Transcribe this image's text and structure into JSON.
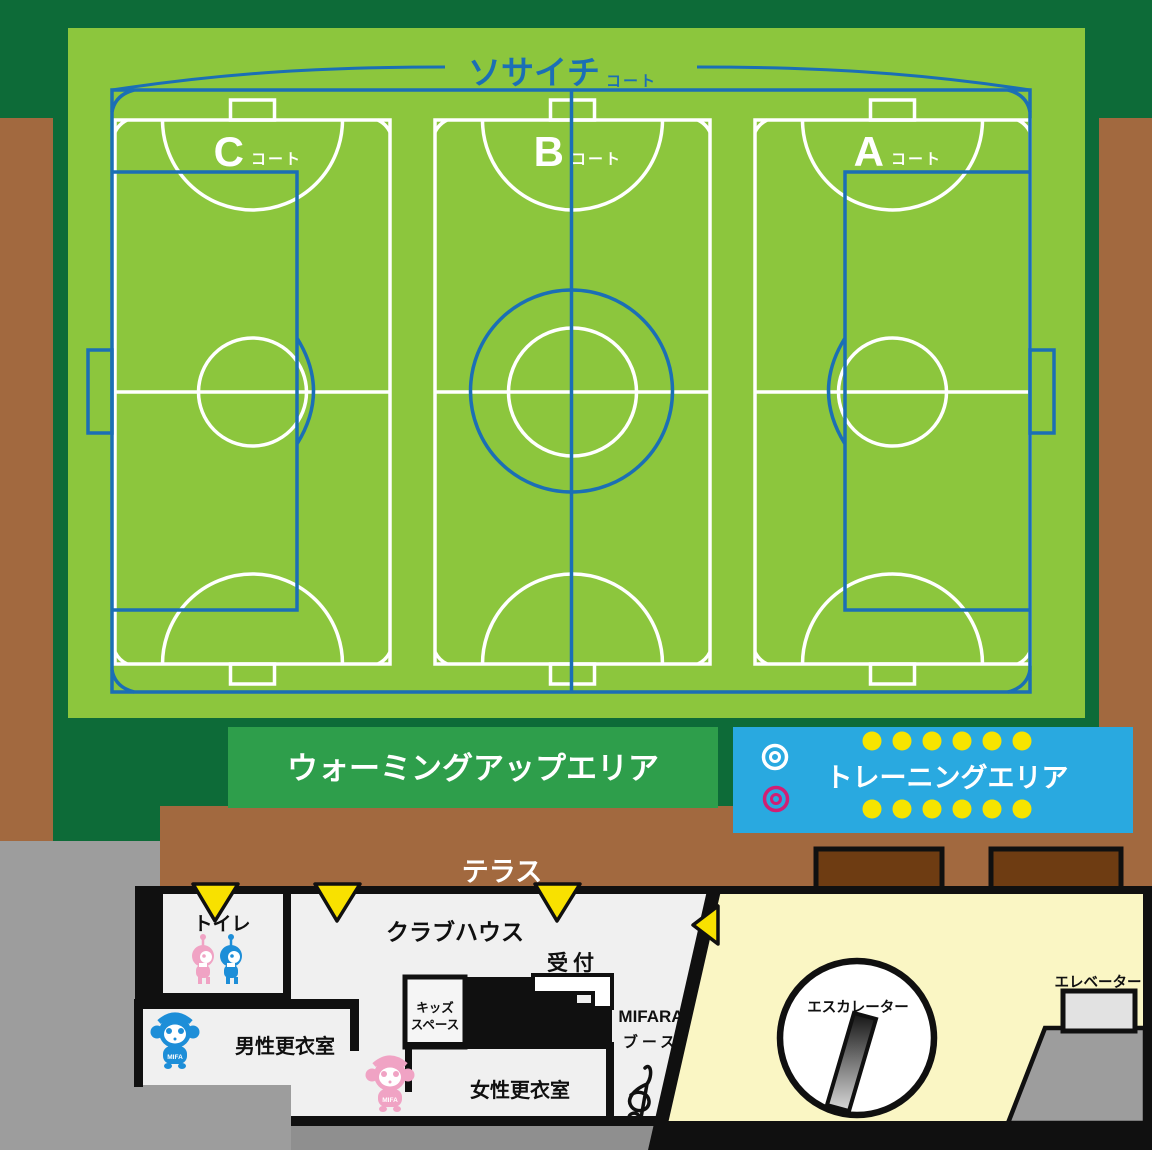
{
  "colors": {
    "dark_green": "#0d6b38",
    "pitch_green": "#8cc63d",
    "court_blue": "#1b6fb5",
    "line_white": "#ffffff",
    "warming_green": "#2e9e4b",
    "training_blue": "#29a9e0",
    "dot_yellow": "#f6e400",
    "target_magenta": "#d11f74",
    "terrace_brown": "#a2693f",
    "planter_brown": "#6e3c12",
    "floor_gray": "#f0f0f0",
    "base_gray": "#9d9d9d",
    "dark_strip_gray": "#8f8f8f",
    "pale_yellow": "#faf6c4",
    "entrance_yellow": "#f8e100",
    "mascot_blue": "#1d8ed8",
    "mascot_pink": "#f0a3c4",
    "elevator_gray": "#e2e2e2",
    "wall_black": "#101010"
  },
  "pitch": {
    "title": "ソサイチ",
    "title_suffix": "コート",
    "courts": [
      {
        "letter": "C",
        "suffix": "コート"
      },
      {
        "letter": "B",
        "suffix": "コート"
      },
      {
        "letter": "A",
        "suffix": "コート"
      }
    ]
  },
  "areas": {
    "warming_up": "ウォーミングアップエリア",
    "training": "トレーニングエリア",
    "terrace": "テラス"
  },
  "building": {
    "toilet": "トイレ",
    "clubhouse": "クラブハウス",
    "reception": "受付",
    "kids_space_line1": "キッズ",
    "kids_space_line2": "スペース",
    "mens_room": "男性更衣室",
    "womens_room": "女性更衣室",
    "booth_line1": "MIFARA",
    "booth_line2": "ブース",
    "escalator": "エスカレーター",
    "elevator": "エレベーター",
    "mascot_label": "MIFA"
  },
  "icons": {
    "entrance_arrow": "▼",
    "target": "◎",
    "training_dot": "●",
    "treble_clef": "g-clef",
    "escalator_symbol": "ramp-in-circle"
  }
}
